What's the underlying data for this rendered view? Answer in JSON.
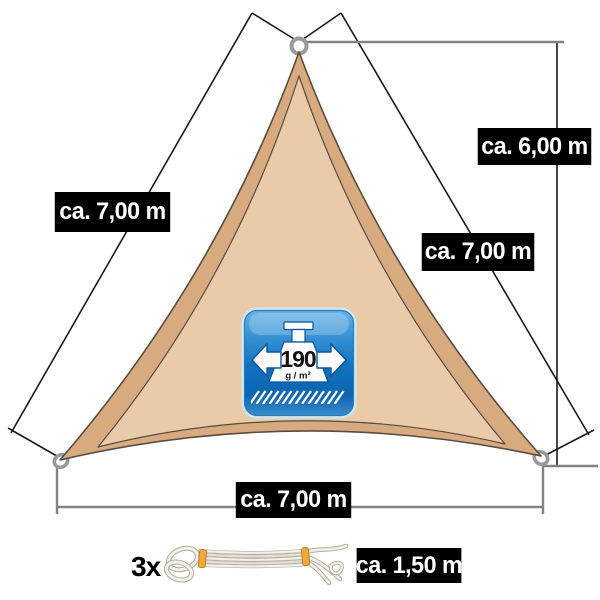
{
  "diagram": {
    "title_hint": "triangular shade sail with dimensions",
    "dimensions": {
      "left_edge": "ca. 7,00 m",
      "height": "ca. 6,00 m",
      "right_edge": "ca. 7,00 m",
      "bottom_edge": "ca. 7,00 m"
    },
    "badge": {
      "weight_value": "190",
      "weight_unit": "g / m²"
    },
    "rope": {
      "quantity": "3x",
      "length": "ca. 1,50 m"
    }
  },
  "colors": {
    "sail_inner": "#e9caa9",
    "sail_border_band": "#d8aa80",
    "sail_outline": "#5a4c3f",
    "badge_blue_dark": "#0d65af",
    "badge_blue_light": "#5aade4",
    "label_background": "#000000",
    "label_text": "#ffffff",
    "dimension_line_grey": "#828282",
    "dimension_line_black": "#1a1a1a",
    "ring_grey": "#999999",
    "rope_band_orange": "#eda93b"
  }
}
